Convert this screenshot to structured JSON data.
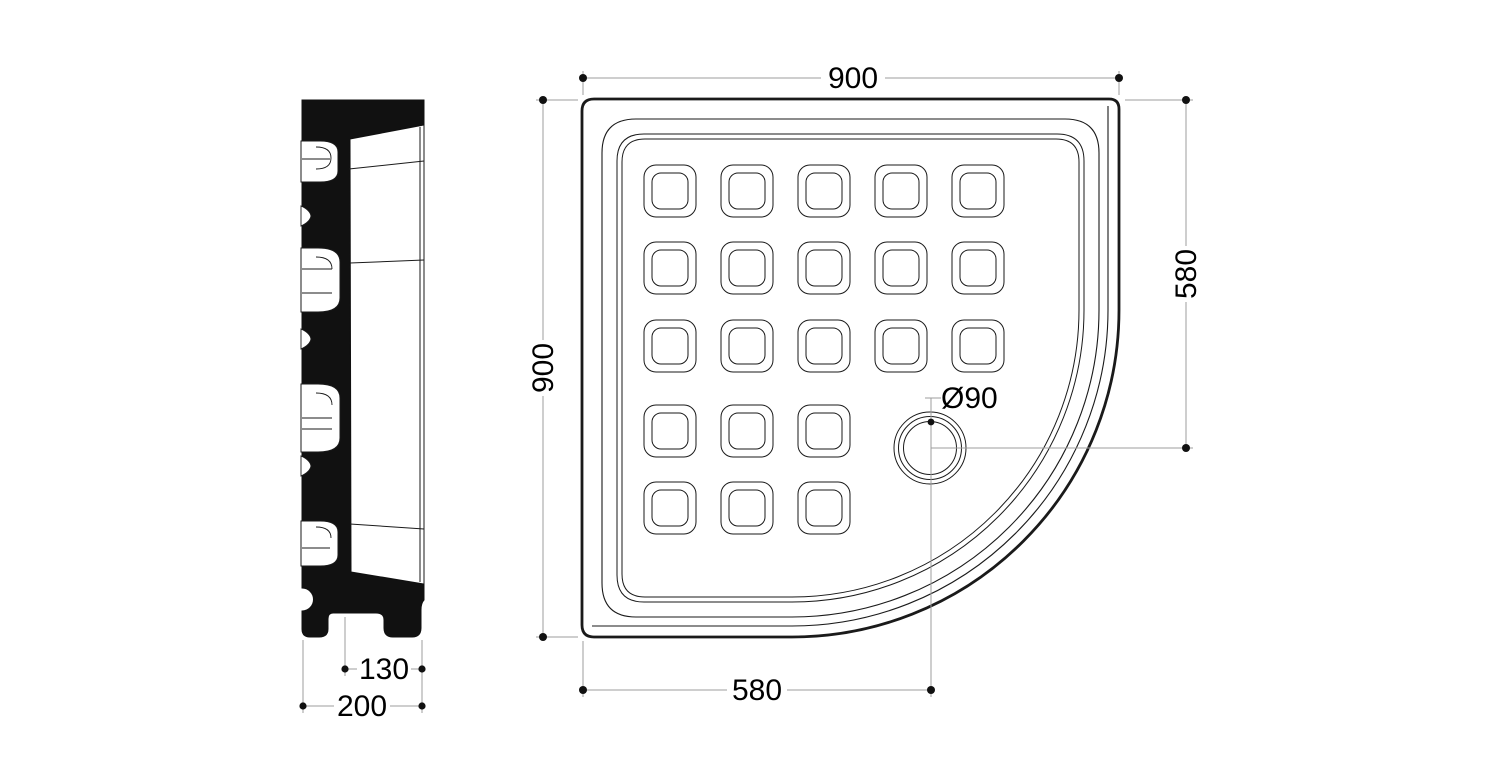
{
  "drawing": {
    "type": "technical-drawing",
    "subject": "quadrant-shower-tray",
    "colors": {
      "background": "#ffffff",
      "geometry_line": "#1a1a1a",
      "dimension_line": "#9c9c9c",
      "text": "#000000",
      "section_fill": "#111111"
    },
    "dimensions": {
      "top_width": "900",
      "left_height": "900",
      "right_height": "580",
      "bottom_drain_offset": "580",
      "drain_diameter": "Ø90",
      "side_inner_depth": "130",
      "side_overall_depth": "200"
    }
  }
}
